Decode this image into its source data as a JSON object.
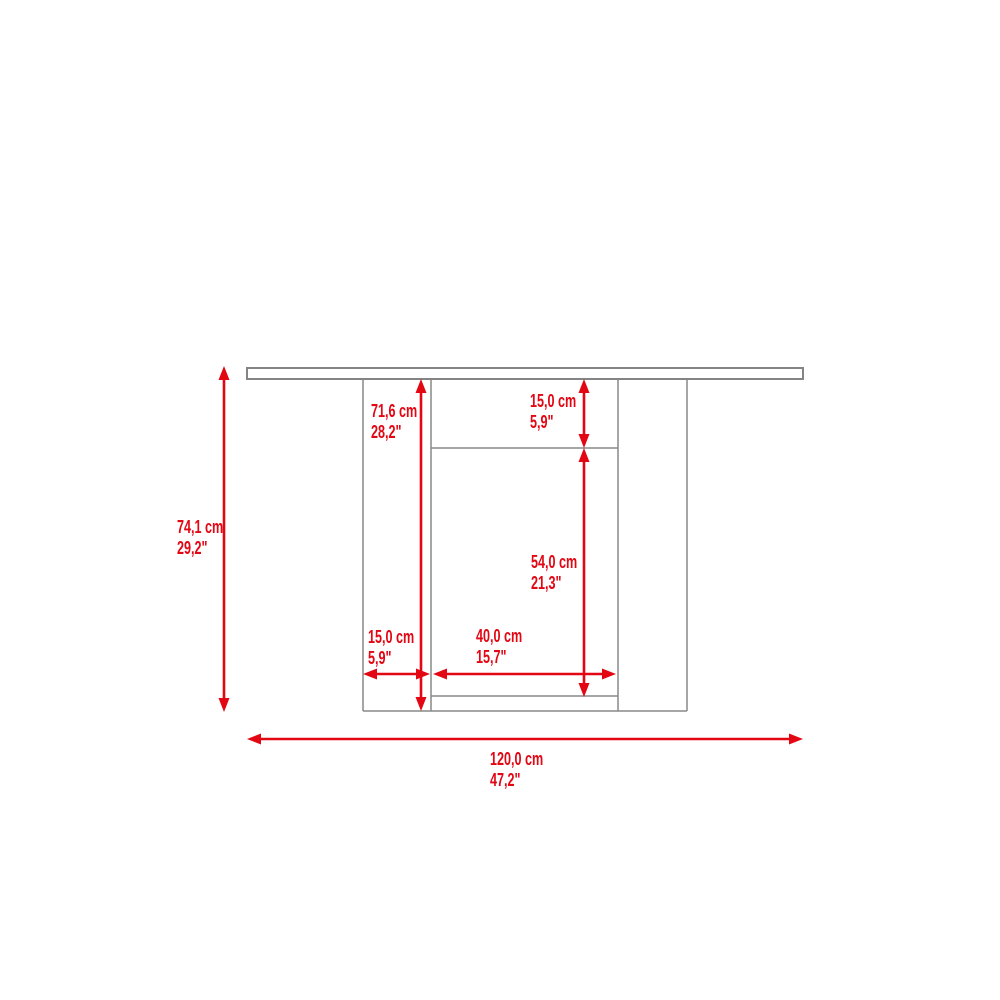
{
  "diagram": {
    "kind": "furniture-dimension-drawing",
    "subject": "table front elevation with side panels and open center compartment",
    "accent_color": "#e30613",
    "outline_color": "#898989",
    "background_color": "#ffffff",
    "dimensions": {
      "overall_height": {
        "cm": "74,1 cm",
        "in": "29,2\""
      },
      "interior_height": {
        "cm": "71,6 cm",
        "in": "28,2\""
      },
      "top_opening_height": {
        "cm": "15,0 cm",
        "in": "5,9\""
      },
      "center_opening_height": {
        "cm": "54,0 cm",
        "in": "21,3\""
      },
      "side_panel_width": {
        "cm": "15,0 cm",
        "in": "5,9\""
      },
      "center_opening_width": {
        "cm": "40,0 cm",
        "in": "15,7\""
      },
      "overall_width": {
        "cm": "120,0 cm",
        "in": "47,2\""
      }
    }
  }
}
